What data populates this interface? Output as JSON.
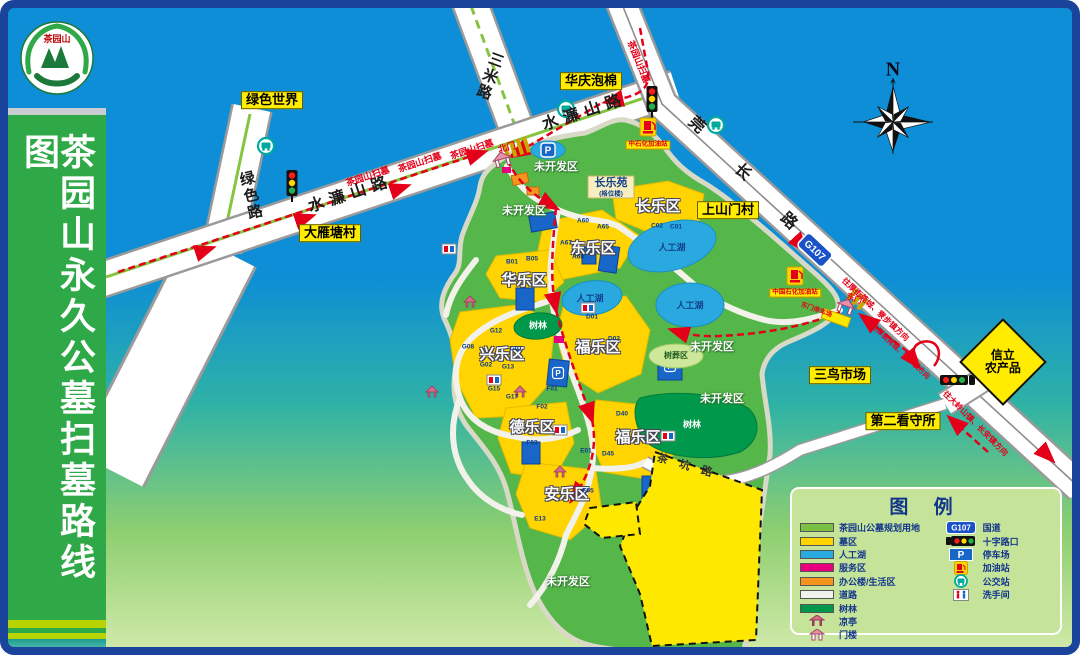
{
  "title_panel": {
    "title": "茶园山永久公墓扫墓路线图",
    "logo_text": "茶园山"
  },
  "compass_label": "N",
  "roads": {
    "shuilianshan": "水濂山路",
    "lvse": "绿色路",
    "sanmi": "三米路",
    "guanchang_1": "莞",
    "guanchang_2": "长",
    "guanchang_3": "路",
    "chakeng": "茶坑路",
    "g107": "G107"
  },
  "route": {
    "saomu": "茶园山扫墓",
    "dir_northeast": "往厚街莞城、寮步镇方向",
    "dir_southwest": "往大岭山镇、长安镇方向"
  },
  "gates": {
    "north": "北门",
    "east": "东门",
    "east_parking": "东门停车场",
    "parking_p": "P"
  },
  "landmarks": {
    "lvse_world": "绿色世界",
    "huaqing": "华庆泡棉",
    "dayantang": "大雁塘村",
    "shangshanmen": "上山门村",
    "sanniao": "三鸟市场",
    "kanshousuo": "第二看守所",
    "xinli_line1": "信立",
    "xinli_line2": "农产品"
  },
  "gas_stations": {
    "north": "中石化加油站",
    "east": "中国石化加油站"
  },
  "zones": {
    "changle": "长乐区",
    "dongle": "东乐区",
    "huale": "华乐区",
    "xingle": "兴乐区",
    "fule": "福乐区",
    "dele": "德乐区",
    "anle": "安乐区"
  },
  "areas": {
    "undeveloped": "未开发区",
    "lake": "人工湖",
    "forest": "树林",
    "tree_burial": "树葬区",
    "changleyuan": "长乐苑",
    "changleyuan_sub": "(格位楼)"
  },
  "plot_codes": [
    "A60",
    "A65",
    "A67",
    "A68",
    "C01",
    "C02",
    "B01",
    "B05",
    "G01",
    "G12",
    "G08",
    "G02",
    "G13",
    "G15",
    "G17",
    "D01",
    "D02",
    "D40",
    "D45",
    "F01",
    "F02",
    "F03",
    "E01",
    "E05",
    "E13"
  ],
  "legend": {
    "title": "图 例",
    "left": [
      {
        "label": "茶园山公墓规划用地",
        "color": "#7ac143"
      },
      {
        "label": "墓区",
        "color": "#ffd400"
      },
      {
        "label": "人工湖",
        "color": "#29abe2"
      },
      {
        "label": "服务区",
        "color": "#e6007e"
      },
      {
        "label": "办公楼/生活区",
        "color": "#f7941d"
      },
      {
        "label": "道路",
        "color": "#f2f2ec"
      },
      {
        "label": "树林",
        "color": "#00984a"
      },
      {
        "label": "凉亭",
        "color": ""
      },
      {
        "label": "门楼",
        "color": ""
      }
    ],
    "right": [
      {
        "label": "国道"
      },
      {
        "label": "十字路口"
      },
      {
        "label": "停车场"
      },
      {
        "label": "加油站"
      },
      {
        "label": "公交站"
      },
      {
        "label": "洗手间"
      }
    ]
  }
}
